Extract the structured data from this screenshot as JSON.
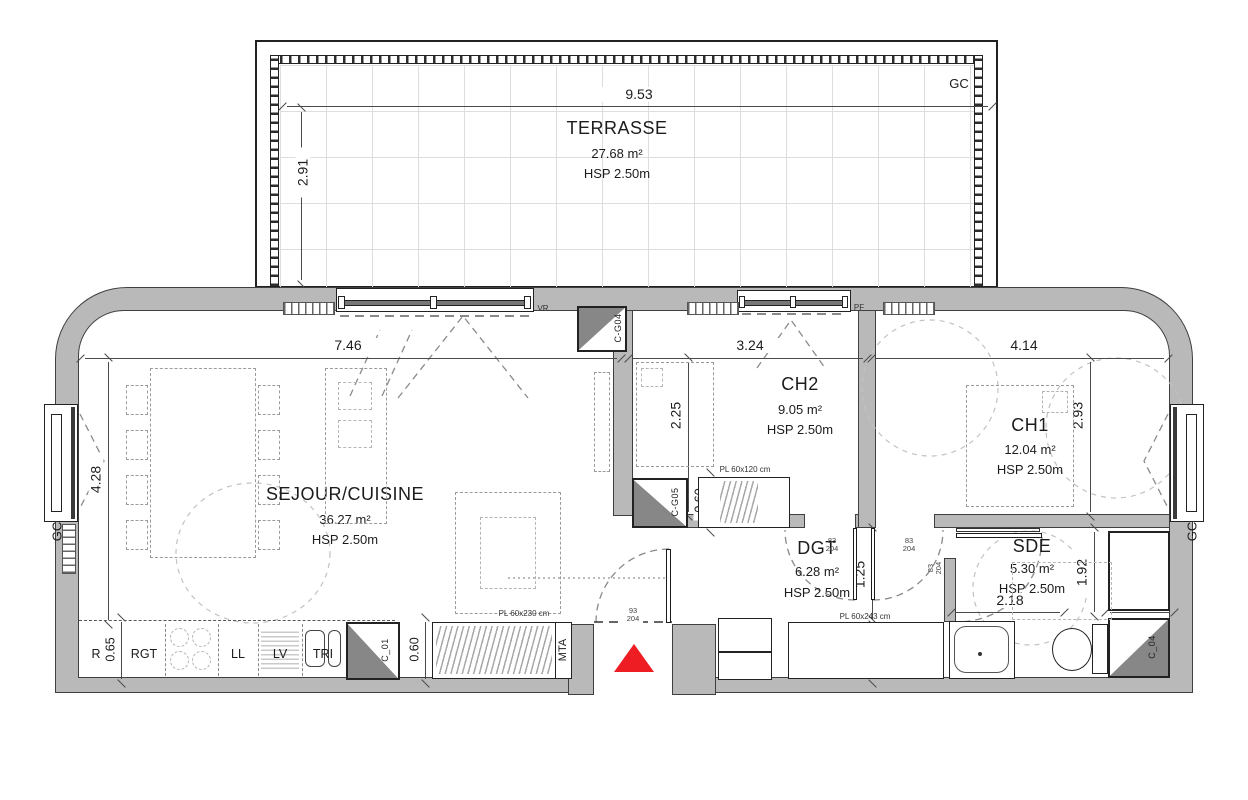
{
  "colors": {
    "wall_fill": "#b9b9b9",
    "outline": "#3f3f3f",
    "duct_fill": "#878787",
    "entry_arrow": "#ee1c23",
    "furniture_dash": "#9b9b9b"
  },
  "terrace": {
    "name": "TERRASSE",
    "area": "27.68 m²",
    "hsp": "HSP 2.50m",
    "dim_w": "9.53",
    "dim_d": "2.91",
    "gc": "GC"
  },
  "rooms": {
    "sejour": {
      "name": "SEJOUR/CUISINE",
      "area": "36.27 m²",
      "hsp": "HSP 2.50m"
    },
    "ch2": {
      "name": "CH2",
      "area": "9.05 m²",
      "hsp": "HSP 2.50m"
    },
    "ch1": {
      "name": "CH1",
      "area": "12.04 m²",
      "hsp": "HSP 2.50m"
    },
    "dgt": {
      "name": "DGT",
      "area": "6.28 m²",
      "hsp": "HSP 2.50m"
    },
    "sde": {
      "name": "SDE",
      "area": "5.30 m²",
      "hsp": "HSP 2.50m"
    }
  },
  "dimensions": {
    "sejour_w": "7.46",
    "sejour_h": "4.28",
    "ch2_w": "3.24",
    "ch2_h": "2.25",
    "ch1_w": "4.14",
    "ch1_h": "2.93",
    "dgt_h": "1.25",
    "dgt_closet_h": "0.61",
    "sde_w": "2.18",
    "sde_h": "1.92",
    "sde_closet_w": "0.91",
    "ch2_closet_w": "0.60",
    "entry_closet_w": "0.60",
    "kitchen_w": "0.65"
  },
  "labels": {
    "gc": "GC",
    "vr": "VR",
    "pf": "PF",
    "mta": "MTA",
    "kitchen": {
      "fridge": "R",
      "storage": "RGT",
      "washer": "LL",
      "dishwasher": "LV",
      "sink": "TRI"
    },
    "closets": {
      "ch2": "PL 60x120 cm",
      "entry": "PL 60x230 cm",
      "dgt": "PL 60x243 cm"
    },
    "ducts": {
      "g04": "C-G04",
      "g05": "C-G05",
      "c01": "C_01",
      "c04": "C_04"
    },
    "doors": {
      "std_w": "83",
      "std_h": "204",
      "entry_w": "93",
      "entry_h": "204"
    }
  }
}
